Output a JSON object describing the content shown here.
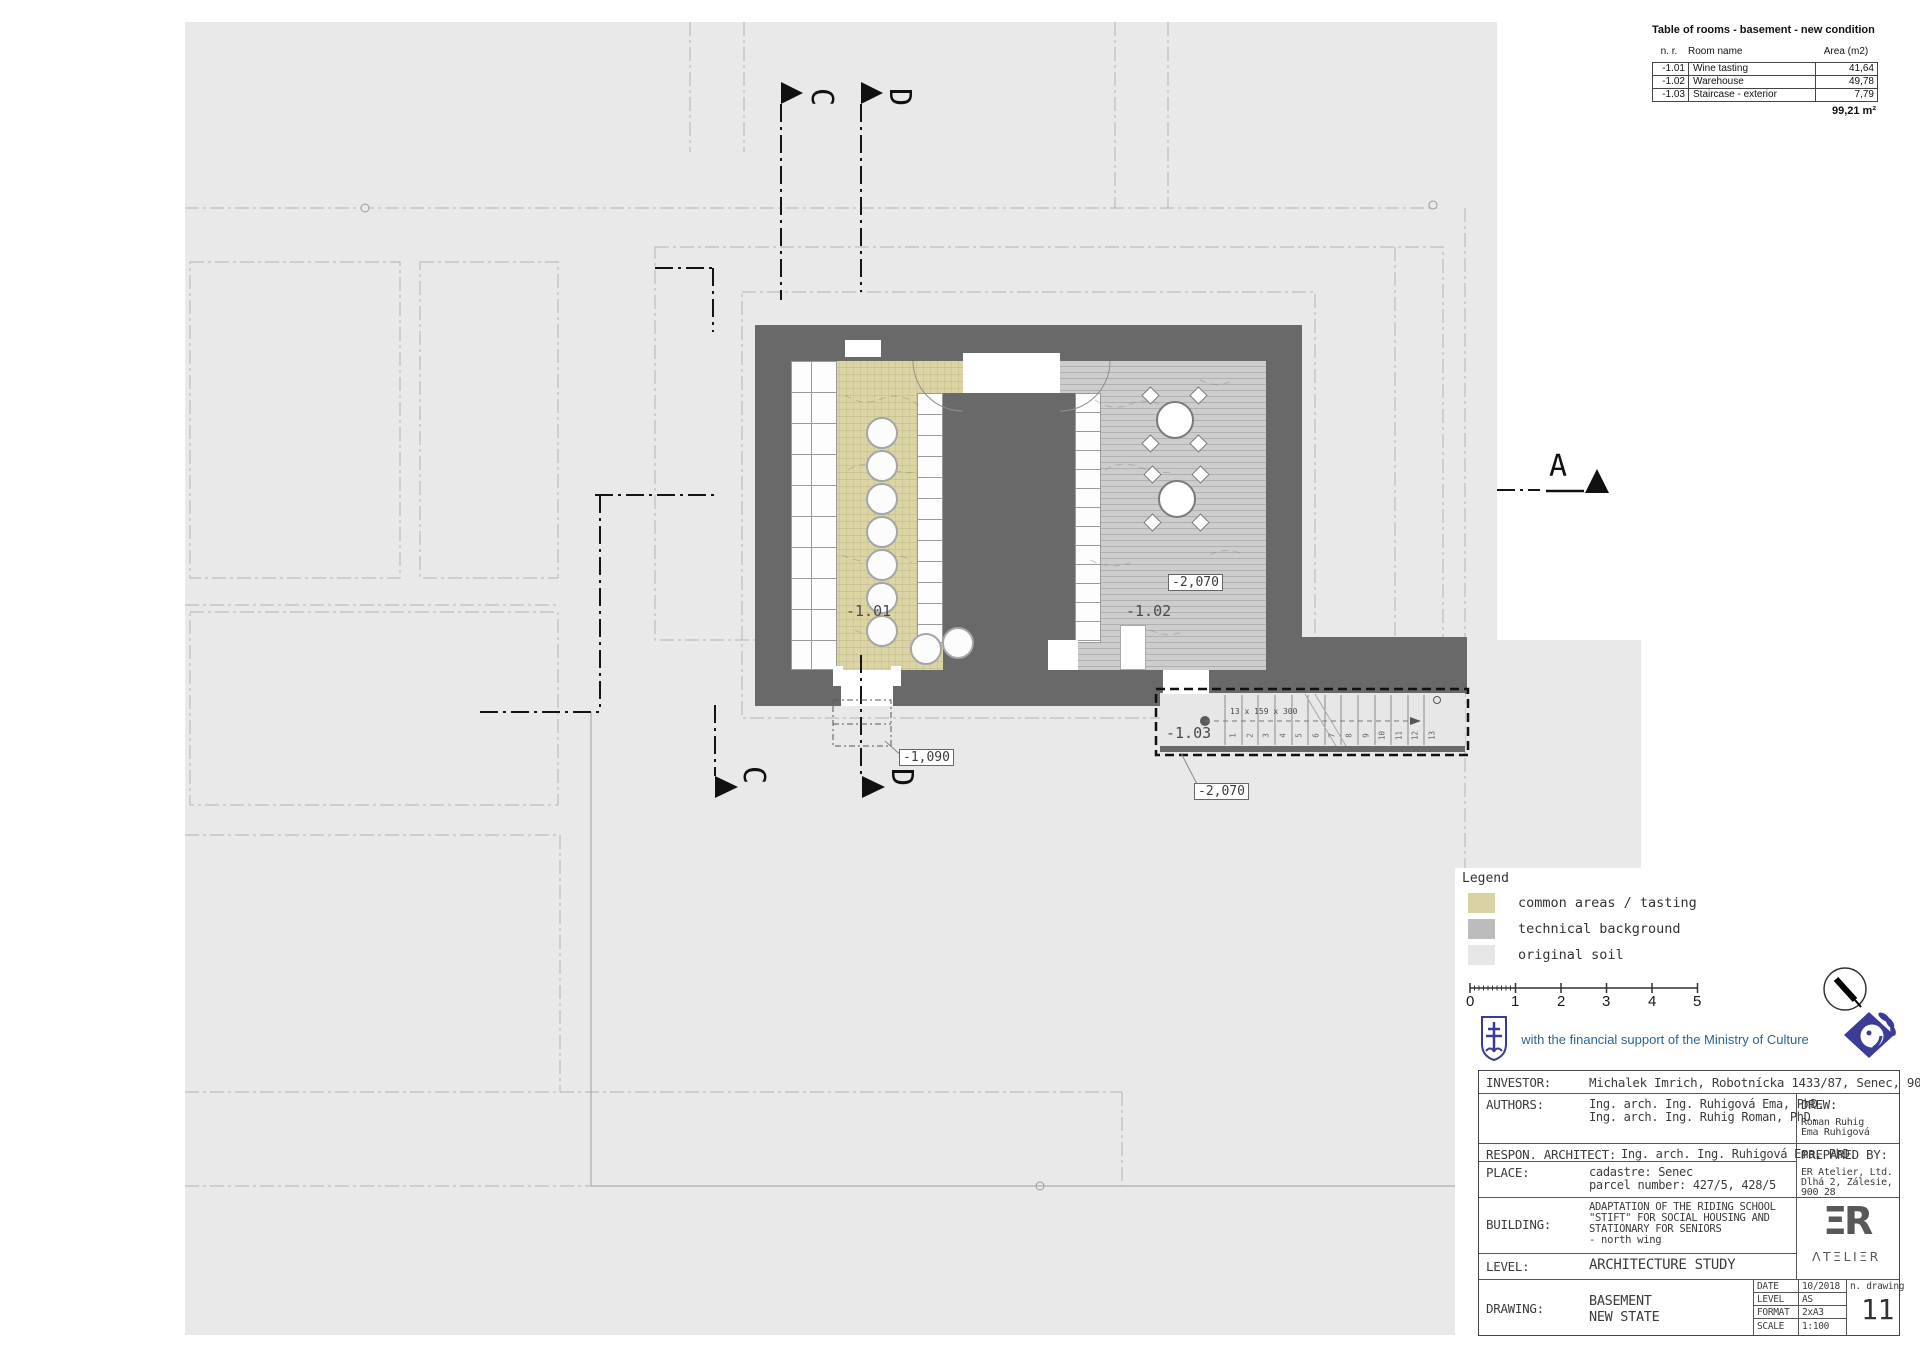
{
  "rooms_table": {
    "title": "Table of rooms - basement - new condition",
    "col_nr": "n. r.",
    "col_name": "Room name",
    "col_area": "Area (m2)",
    "rows": [
      {
        "nr": "-1.01",
        "name": "Wine tasting",
        "area": "41,64"
      },
      {
        "nr": "-1.02",
        "name": "Warehouse",
        "area": "49,78"
      },
      {
        "nr": "-1.03",
        "name": "Staircase - exterior",
        "area": "7,79"
      }
    ],
    "total": "99,21 m²"
  },
  "plan": {
    "room_101": "-1.01",
    "room_102": "-1.02",
    "room_103": "-1.03",
    "elev_warehouse": "-2,070",
    "elev_stairs": "-2,070",
    "elev_entry": "-1,090",
    "stair_note": "13 x 159 x 300",
    "steps": [
      "1",
      "2",
      "3",
      "4",
      "5",
      "6",
      "7",
      "8",
      "9",
      "10",
      "11",
      "12",
      "13"
    ],
    "section_c_top": "C",
    "section_d_top": "D",
    "section_c_bottom": "C",
    "section_d_bottom": "D",
    "section_a": "A"
  },
  "legend": {
    "title": "Legend",
    "item_common": "common areas / tasting",
    "item_technical": "technical background",
    "item_soil": "original soil",
    "color_common": "#d9d3a4",
    "color_technical": "#bcbcbc",
    "color_soil": "#e6e6e6"
  },
  "scalebar": {
    "t0": "0",
    "t1": "1",
    "t2": "2",
    "t3": "3",
    "t4": "4",
    "t5": "5"
  },
  "support": {
    "text": "with the financial support of the Ministry of Culture"
  },
  "titleblock": {
    "investor_label": "INVESTOR:",
    "investor": "Michalek Imrich, Robotnícka 1433/87, Senec, 903 01",
    "authors_label": "AUTHORS:",
    "authors_line1": "Ing. arch. Ing. Ruhigová Ema, PhD.",
    "authors_line2": "Ing. arch. Ing. Ruhig Roman, PhD.",
    "drew_label": "DREW:",
    "drew_line1": "Roman Ruhig",
    "drew_line2": "Ema Ruhigová",
    "respon_label": "RESPON. ARCHITECT:",
    "respon": "Ing. arch. Ing. Ruhigová Ema, PhD.",
    "place_label": "PLACE:",
    "place_line1": "cadastre: Senec",
    "place_line2": "parcel number: 427/5, 428/5",
    "prepared_label": "PREPARED BY:",
    "prepared_line1": "ER Atelier, Ltd.",
    "prepared_line2": "Dlhá 2, Zálesie,",
    "prepared_line3": "900 28",
    "building_label": "BUILDING:",
    "building_line1": "ADAPTATION OF THE RIDING SCHOOL",
    "building_line2": "\"STIFT\" FOR SOCIAL HOUSING AND",
    "building_line3": "STATIONARY FOR SENIORS",
    "building_line4": "- north wing",
    "level_label": "LEVEL:",
    "level": "ARCHITECTURE STUDY",
    "drawing_label": "DRAWING:",
    "drawing_line1": "BASEMENT",
    "drawing_line2": "NEW STATE",
    "meta_date_label": "DATE",
    "meta_date": "10/2018",
    "meta_level_label": "LEVEL",
    "meta_level": "AS",
    "meta_format_label": "FORMAT",
    "meta_format": "2xA3",
    "meta_scale_label": "SCALE",
    "meta_scale": "1:100",
    "ndrawing_label": "n. drawing",
    "ndrawing": "11",
    "logo_er": "ΞR",
    "logo_atelier": "ΛΤΞLΙΞR"
  }
}
